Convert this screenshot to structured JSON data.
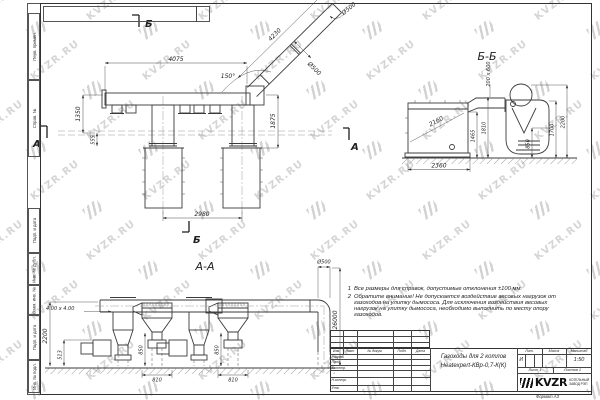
{
  "watermark": {
    "text": "KVZR.RU"
  },
  "margin": {
    "labels": [
      "Перв. примен.",
      "Справ. №",
      "Подп. и дата",
      "Инв. № дубл.",
      "Взам. инв. №",
      "Подп. и дата",
      "Инв. № подл."
    ]
  },
  "front_view": {
    "marker_top": "Б",
    "marker_bottom": "Б",
    "marker_left": "А",
    "marker_right": "А",
    "dim_top_width": "4075",
    "dim_diag_length": "4230",
    "dim_diag_dia": "Ø500",
    "dim_top_dia": "Ø500",
    "dim_angle": "150°",
    "dim_left_height": "1350",
    "dim_left_offset": "555",
    "dim_right_height": "1875",
    "dim_bottom_span": "2980"
  },
  "section_bb": {
    "title": "Б-Б",
    "dim_duct": "200 х 600",
    "dim_boiler_diag": "2160",
    "dim_width": "2360",
    "dim_h1465": "1465",
    "dim_h1810": "1810",
    "dim_h850": "850",
    "dim_h1700": "1700",
    "dim_h2200": "2200"
  },
  "section_aa": {
    "title": "А-А",
    "dim_chimney_dia": "Ø500",
    "dim_chimney_height": "26000",
    "dim_duct_size": "4.00 х 4.00",
    "dim_left_height": "2200",
    "dim_fan_height": "513",
    "dim_cyclone1_drop": "850",
    "dim_cyclone1_width": "810",
    "dim_cyclone2_drop": "850",
    "dim_cyclone2_width": "810"
  },
  "notes": {
    "items": [
      {
        "num": "1",
        "text": "Все размеры для справок, допустимые отклонения ±100 мм."
      },
      {
        "num": "2",
        "text": "Обратите внимание! Не допускается воздействие весовых нагрузок от газоходов на улитку дымососа. Для исключения воздействия весовых нагрузок на улитку дымососа, необходимо выполнить по месту опору газоходов."
      }
    ]
  },
  "title_block": {
    "title_line1": "Газоходы для 2 котлов",
    "title_line2": "Heatexpert-КВр-0,7-К(К)",
    "col_izm": "Изм.",
    "col_list": "Лист",
    "col_doc": "№ докум.",
    "col_podp": "Подп.",
    "col_data": "Дата",
    "row_razrab": "Разраб.",
    "row_prov": "Пров.",
    "row_tkontr": "Т.контр.",
    "row_nkontr": "Н.контр.",
    "row_utv": "Утв.",
    "lit_label": "Лит.",
    "mass_label": "Масса",
    "scale_label": "Масштаб",
    "lit_value": "И",
    "scale_value": "1:50",
    "sheet_label": "Лист",
    "sheet_num": "1",
    "sheets_label": "Листов",
    "sheets_num": "1",
    "brand": "KVZR",
    "brand_line1": "КОТЕЛЬНЫЙ",
    "brand_line2": "ЗАВОД РЭП",
    "format_label": "Формат А3"
  }
}
